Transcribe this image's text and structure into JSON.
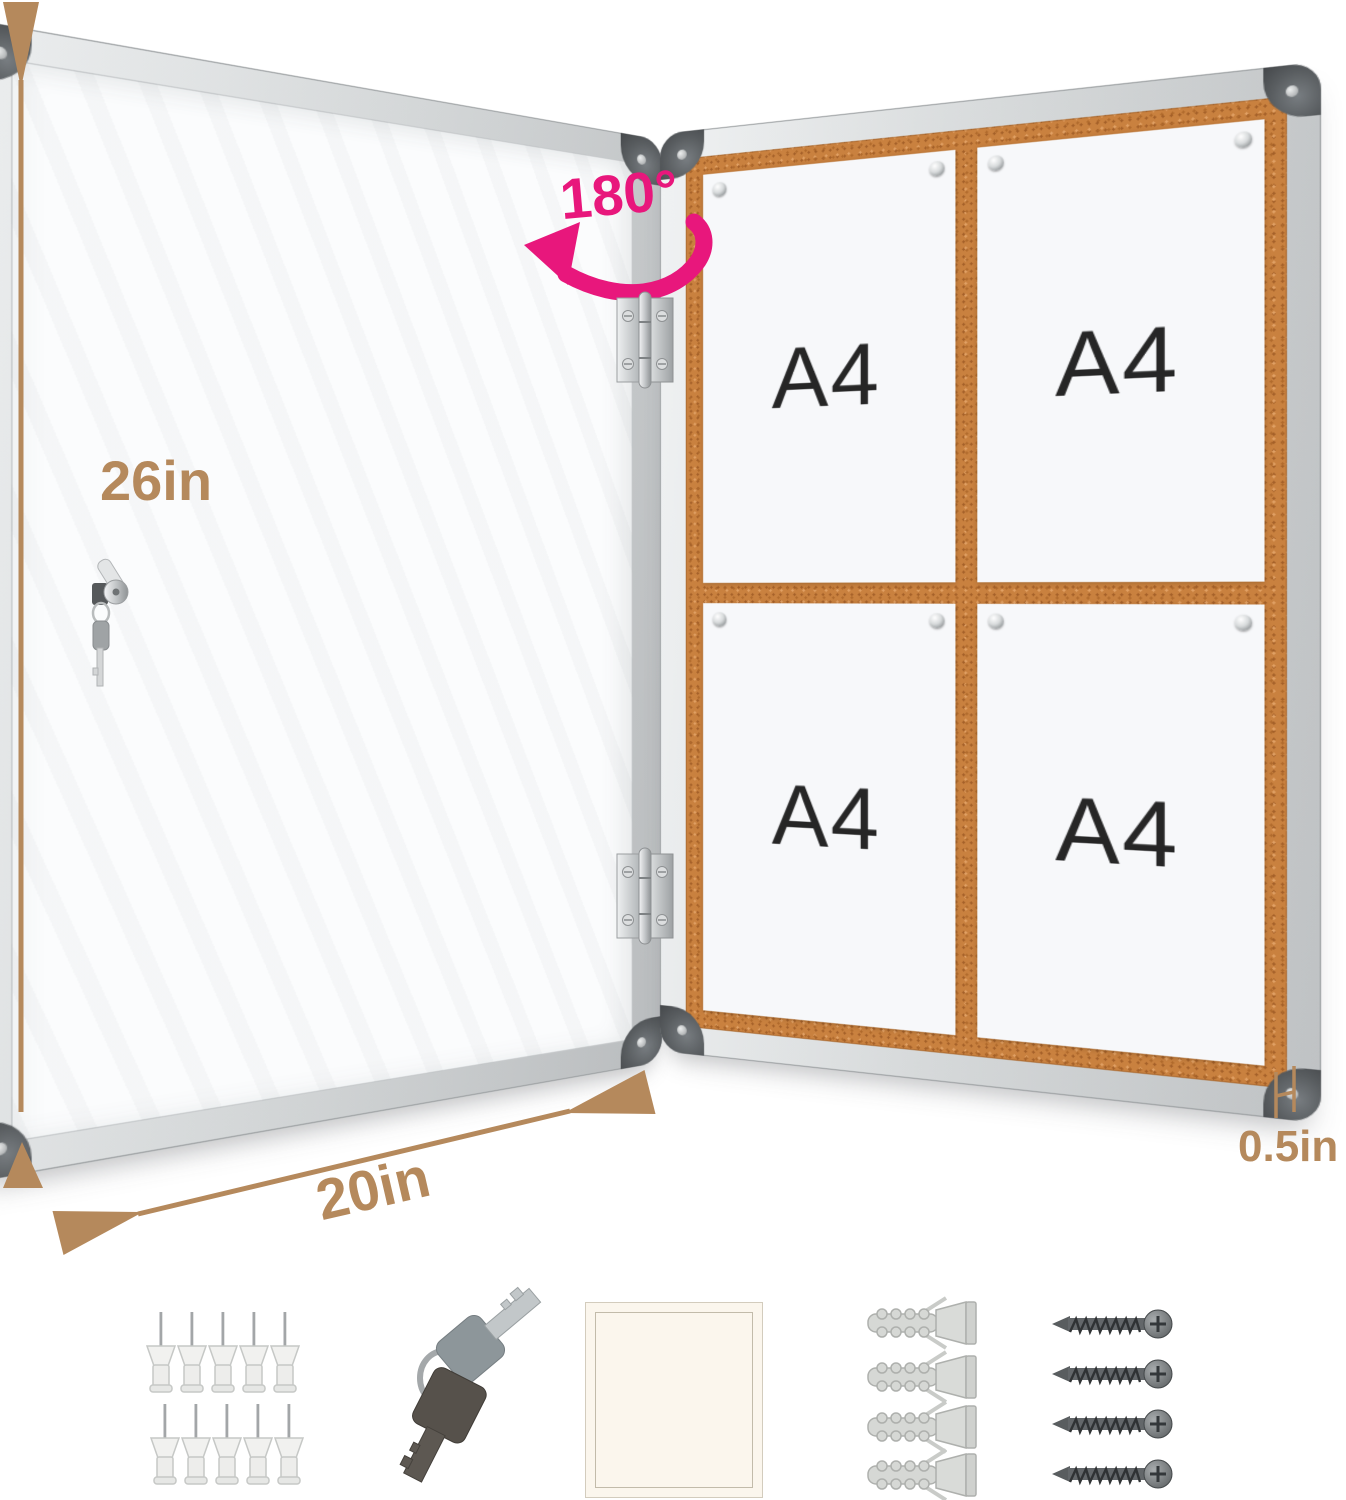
{
  "dimensions": {
    "height_label": "26in",
    "width_label": "20in",
    "depth_label": "0.5in",
    "door_open_angle_label": "180°"
  },
  "board": {
    "papers": [
      {
        "label": "A4"
      },
      {
        "label": "A4"
      },
      {
        "label": "A4"
      },
      {
        "label": "A4"
      }
    ]
  },
  "accessories": {
    "push_pins_count": 10,
    "keys_count": 2,
    "adhesive_pads_count": 1,
    "wall_anchors_count": 4,
    "screws_count": 4
  },
  "colors": {
    "dimension_annotation": "#b5895c",
    "angle_annotation": "#e8177c",
    "cork_surface": "#c9813f",
    "aluminum_frame": "#d2d5d6",
    "paper_text": "#262626"
  }
}
